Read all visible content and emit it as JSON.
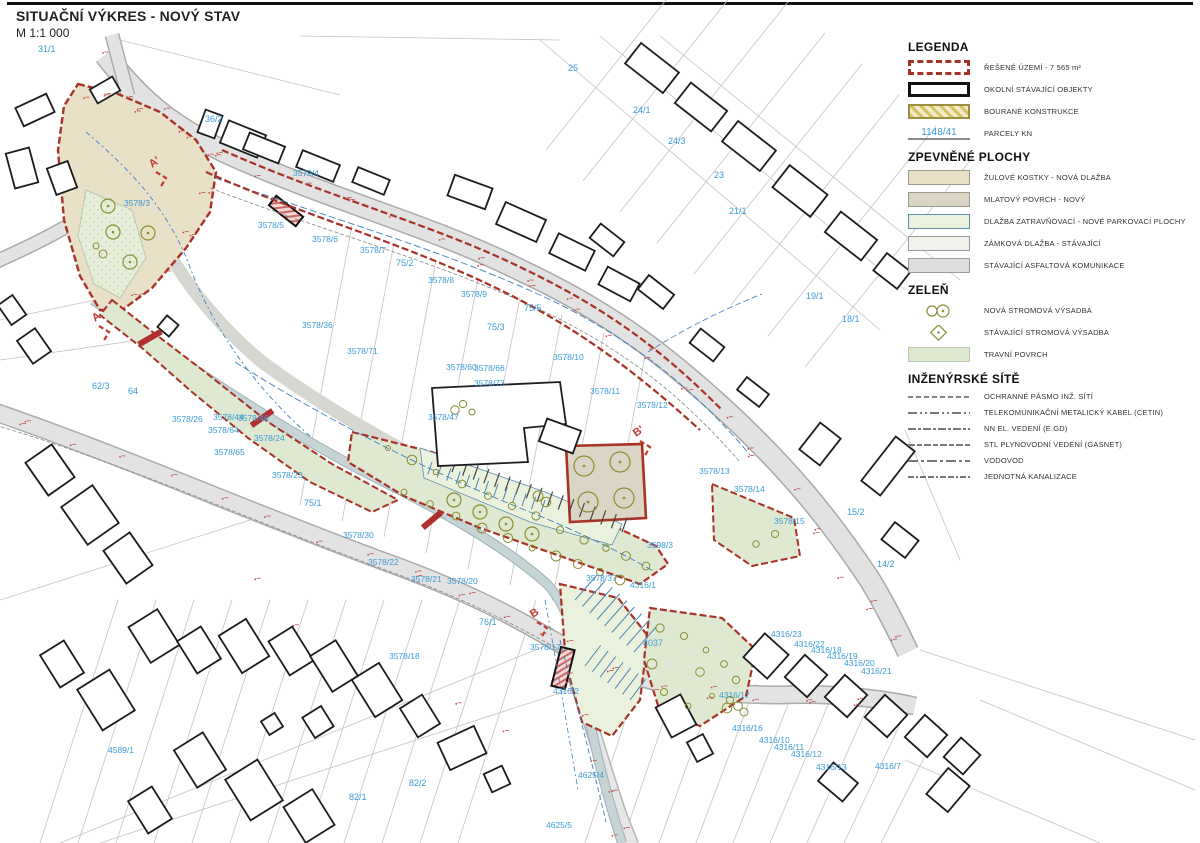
{
  "title": {
    "main": "SITUAČNÍ VÝKRES - NOVÝ STAV",
    "scale": "M 1:1 000"
  },
  "colors": {
    "boundary_red": "#a93226",
    "parcel_blue": "#3a9bd5",
    "granite": "#e8e1c8",
    "mlat": "#dbd5c5",
    "grass_paving": "#eaf2dd",
    "interlock": "#f2f1ec",
    "asphalt": "#dedede",
    "grass": "#dfe9d1",
    "tree_olive": "#8a8f33",
    "utility_blue": "#3f7fbf",
    "stream": "#c6d4d6",
    "annotation_red": "#c0504d"
  },
  "legend": {
    "heading": "LEGENDA",
    "items": [
      {
        "swatch": "boundary",
        "label": "ŘEŠENÉ ÚZEMÍ  - 7 565 m²"
      },
      {
        "swatch": "building",
        "label": "OKOLNÍ STÁVAJÍCÍ OBJEKTY"
      },
      {
        "swatch": "demolished",
        "label": "BOURANÉ KONSTRUKCE"
      },
      {
        "swatch": "parcel",
        "label": "PARCELY KN",
        "sample": "1148/41"
      }
    ],
    "sections": [
      {
        "heading": "ZPEVNĚNÉ PLOCHY",
        "items": [
          {
            "swatch": "granite",
            "label": "ŽULOVÉ KOSTKY - NOVÁ DLAŽBA"
          },
          {
            "swatch": "mlat",
            "label": "MLATOVÝ POVRCH - NOVÝ"
          },
          {
            "swatch": "grass-paving",
            "label": "DLAŽBA ZATRAVŇOVACÍ - NOVÉ PARKOVACÍ PLOCHY"
          },
          {
            "swatch": "interlock",
            "label": "ZÁMKOVÁ DLAŽBA - STÁVAJÍCÍ"
          },
          {
            "swatch": "asphalt",
            "label": "STÁVAJÍCÍ ASFALTOVÁ KOMUNIKACE"
          }
        ]
      },
      {
        "heading": "ZELEŇ",
        "items": [
          {
            "swatch": "new-tree",
            "label": "NOVÁ STROMOVÁ VÝSADBA"
          },
          {
            "swatch": "existing-tree",
            "label": "STÁVAJÍCÍ STROMOVÁ VÝSADBA"
          },
          {
            "swatch": "grass",
            "label": "TRAVNÍ POVRCH"
          }
        ]
      },
      {
        "heading": "INŽENÝRSKÉ SÍTĚ",
        "items": [
          {
            "swatch": "line-pasmo",
            "label": "OCHRANNÉ PÁSMO INŽ. SÍTÍ"
          },
          {
            "swatch": "line-telecom",
            "label": "TELEKOMUNIKAČNÍ METALICKÝ KABEL (CETIN)"
          },
          {
            "swatch": "line-nn",
            "label": "NN EL. VEDENÍ (E.GD)"
          },
          {
            "swatch": "line-gas",
            "label": "STL PLYNOVODNÍ VEDENÍ (GASNET)"
          },
          {
            "swatch": "line-voda",
            "label": "VODOVOD"
          },
          {
            "swatch": "line-kanal",
            "label": "JEDNOTNÁ KANALIZACE"
          }
        ]
      }
    ]
  },
  "map": {
    "parcel_labels": [
      {
        "t": "31/1",
        "x": 38,
        "y": 52
      },
      {
        "t": "36/2",
        "x": 205,
        "y": 122
      },
      {
        "t": "25",
        "x": 568,
        "y": 71
      },
      {
        "t": "24/1",
        "x": 633,
        "y": 113
      },
      {
        "t": "24/3",
        "x": 668,
        "y": 144
      },
      {
        "t": "23",
        "x": 714,
        "y": 178
      },
      {
        "t": "21/1",
        "x": 729,
        "y": 214
      },
      {
        "t": "19/1",
        "x": 806,
        "y": 299
      },
      {
        "t": "18/1",
        "x": 842,
        "y": 322
      },
      {
        "t": "3579/4",
        "x": 293,
        "y": 176
      },
      {
        "t": "3578/3",
        "x": 124,
        "y": 206
      },
      {
        "t": "3578/5",
        "x": 258,
        "y": 228
      },
      {
        "t": "3578/6",
        "x": 312,
        "y": 242
      },
      {
        "t": "3578/7",
        "x": 360,
        "y": 253
      },
      {
        "t": "75/2",
        "x": 396,
        "y": 266
      },
      {
        "t": "3578/8",
        "x": 428,
        "y": 283
      },
      {
        "t": "3578/9",
        "x": 461,
        "y": 297
      },
      {
        "t": "75/5",
        "x": 524,
        "y": 311
      },
      {
        "t": "75/3",
        "x": 487,
        "y": 330
      },
      {
        "t": "3578/36",
        "x": 302,
        "y": 328
      },
      {
        "t": "3578/71",
        "x": 347,
        "y": 354
      },
      {
        "t": "3578/60",
        "x": 446,
        "y": 370
      },
      {
        "t": "3578/66",
        "x": 474,
        "y": 371
      },
      {
        "t": "3578/73",
        "x": 474,
        "y": 386
      },
      {
        "t": "3578/10",
        "x": 553,
        "y": 360
      },
      {
        "t": "3578/11",
        "x": 590,
        "y": 394
      },
      {
        "t": "3578/12",
        "x": 637,
        "y": 408
      },
      {
        "t": "3578/47",
        "x": 428,
        "y": 420
      },
      {
        "t": "62/3",
        "x": 92,
        "y": 389
      },
      {
        "t": "64",
        "x": 128,
        "y": 394
      },
      {
        "t": "3578/26",
        "x": 172,
        "y": 422
      },
      {
        "t": "3578/44",
        "x": 213,
        "y": 420
      },
      {
        "t": "3578/46",
        "x": 238,
        "y": 421
      },
      {
        "t": "3578/64",
        "x": 208,
        "y": 433
      },
      {
        "t": "3578/65",
        "x": 214,
        "y": 455
      },
      {
        "t": "3578/24",
        "x": 254,
        "y": 441
      },
      {
        "t": "3578/23",
        "x": 272,
        "y": 478
      },
      {
        "t": "75/1",
        "x": 304,
        "y": 506
      },
      {
        "t": "3578/13",
        "x": 699,
        "y": 474
      },
      {
        "t": "3578/14",
        "x": 734,
        "y": 492
      },
      {
        "t": "3578/15",
        "x": 774,
        "y": 524
      },
      {
        "t": "15/2",
        "x": 847,
        "y": 515
      },
      {
        "t": "14/2",
        "x": 877,
        "y": 567
      },
      {
        "t": "3598/3",
        "x": 647,
        "y": 548
      },
      {
        "t": "3578/30",
        "x": 343,
        "y": 538
      },
      {
        "t": "3578/22",
        "x": 368,
        "y": 565
      },
      {
        "t": "3578/21",
        "x": 411,
        "y": 582
      },
      {
        "t": "3578/20",
        "x": 447,
        "y": 584
      },
      {
        "t": "3578/37",
        "x": 586,
        "y": 581
      },
      {
        "t": "4316/1",
        "x": 630,
        "y": 588
      },
      {
        "t": "76/1",
        "x": 479,
        "y": 625
      },
      {
        "t": "3578/17",
        "x": 530,
        "y": 650
      },
      {
        "t": "3578/18",
        "x": 389,
        "y": 659
      },
      {
        "t": "4037",
        "x": 643,
        "y": 646
      },
      {
        "t": "4316/2",
        "x": 553,
        "y": 694
      },
      {
        "t": "4316/23",
        "x": 771,
        "y": 637
      },
      {
        "t": "4316/22",
        "x": 794,
        "y": 647
      },
      {
        "t": "4316/18",
        "x": 811,
        "y": 653
      },
      {
        "t": "4316/19",
        "x": 827,
        "y": 659
      },
      {
        "t": "4316/20",
        "x": 844,
        "y": 666
      },
      {
        "t": "4316/21",
        "x": 861,
        "y": 674
      },
      {
        "t": "4316/17",
        "x": 719,
        "y": 698
      },
      {
        "t": "4316/16",
        "x": 732,
        "y": 731
      },
      {
        "t": "4316/10",
        "x": 759,
        "y": 743
      },
      {
        "t": "4316/11",
        "x": 774,
        "y": 750
      },
      {
        "t": "4316/12",
        "x": 791,
        "y": 757
      },
      {
        "t": "4316/13",
        "x": 816,
        "y": 770
      },
      {
        "t": "4316/7",
        "x": 875,
        "y": 769
      },
      {
        "t": "4589/1",
        "x": 108,
        "y": 753
      },
      {
        "t": "82/1",
        "x": 349,
        "y": 800
      },
      {
        "t": "82/2",
        "x": 409,
        "y": 786
      },
      {
        "t": "4625/4",
        "x": 578,
        "y": 778
      },
      {
        "t": "4625/5",
        "x": 546,
        "y": 828
      }
    ],
    "section_markers": [
      {
        "t": "A",
        "x": 95,
        "y": 322
      },
      {
        "t": "A'",
        "x": 152,
        "y": 168
      },
      {
        "t": "B",
        "x": 533,
        "y": 618
      },
      {
        "t": "B'",
        "x": 636,
        "y": 437
      }
    ]
  }
}
